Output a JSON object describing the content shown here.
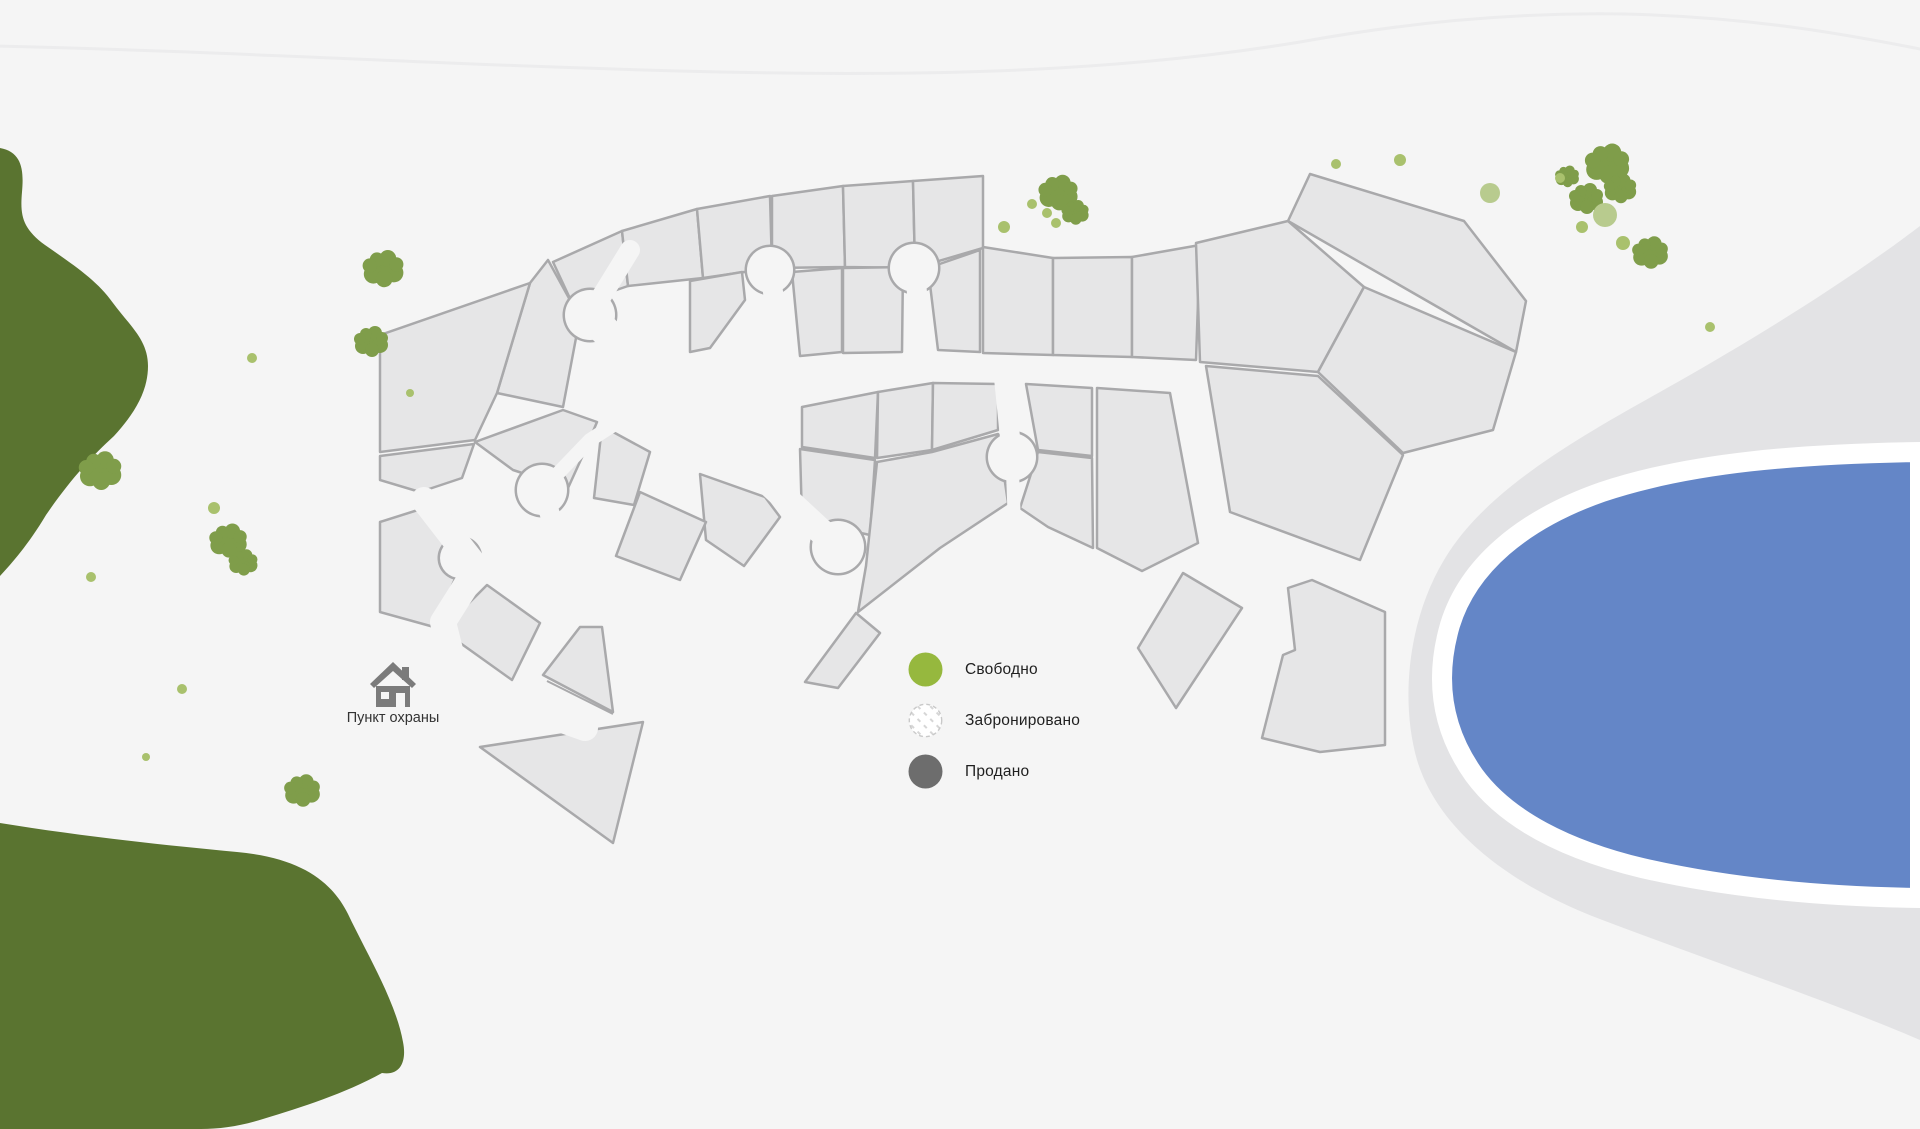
{
  "labels": {
    "security_point": "Пункт охраны"
  },
  "legend": {
    "items": [
      {
        "status": "free",
        "label": "Свободно",
        "color": "#96b83e"
      },
      {
        "status": "reserved",
        "label": "Забронировано",
        "color": "#ffffff",
        "border": "#c9c9c9",
        "pattern": "diagonal-dashes"
      },
      {
        "status": "sold",
        "label": "Продано",
        "color": "#6d6d6d"
      }
    ]
  },
  "palette": {
    "bg": "#f5f5f5",
    "plot": "#e6e6e7",
    "plot_border": "#a9a9ab",
    "forest": "#5a7430",
    "tree": "#7f9d4a",
    "tree_dot": "#a9c16d",
    "tree_dot_light": "#b8cb8e",
    "shore": "#e3e3e5",
    "water": "#6486c7",
    "water_rim": "#ffffff",
    "contour": "#ececed",
    "house_icon": "#7b7b7b"
  },
  "map": {
    "contour_line": "M-5,46 C250,52 460,66 720,72 C950,77 1130,70 1300,42 C1400,24 1505,12 1625,14 C1755,17 1855,36 1925,50",
    "forest": [
      "M0,148 C22,152 24,170 22,192 C20,215 22,228 45,245 C72,264 97,280 113,303 C130,326 148,340 148,366 C148,390 136,412 114,436 C92,456 70,480 46,515 C28,545 12,563 0,576 Z",
      "M0,823 C80,836 162,845 237,852 C302,858 332,882 348,914 C366,952 396,1002 403,1042 C407,1062 400,1076 382,1073 C344,1094 302,1107 263,1119 C241,1126 221,1129 201,1129 L0,1129 Z"
    ],
    "shore": "M1920,226 C1838,288 1742,346 1660,392 C1572,441 1484,492 1444,560 C1408,620 1400,700 1417,760 C1437,826 1502,880 1592,916 C1702,958 1832,1002 1920,1040 Z",
    "water": "M1920,452 C1800,454 1692,462 1602,492 C1522,520 1468,566 1450,625 C1434,680 1442,730 1474,775 C1507,820 1567,850 1642,868 C1742,891 1842,897 1920,898 Z",
    "plots": [
      "553,262 622,231 628,286 573,305",
      "622,231 697,209 703,278 628,286",
      "697,209 770,196 772,268 703,278",
      "772,196 843,186 845,267 772,268",
      "843,186 913,181 915,268 845,267",
      "913,181 983,176 983,248 915,268",
      "690,281 742,272 745,300 710,348 690,352",
      "792,272 842,268 842,352 800,356",
      "843,268 903,267 902,352 843,353",
      "928,268 980,250 980,352 938,350",
      "983,247 1053,258 1053,355 983,353",
      "1053,258 1132,257 1132,357 1053,355",
      "1132,257 1200,245 1196,360 1132,357",
      "1196,243 1288,221 1364,287 1318,372 1200,362",
      "1288,221 1310,174 1464,221 1526,301 1516,352",
      "1364,287 1516,352 1493,430 1403,453 1318,372",
      "1206,366 1318,376 1403,455 1360,560 1230,512",
      "802,407 878,392 875,458 802,447",
      "878,392 933,383 932,450 877,458",
      "933,383 998,384 998,430 932,450",
      "1026,384 1092,388 1092,456 1038,450",
      "1097,388 1170,393 1198,543 1142,571 1097,548",
      "800,449 875,460 870,535 802,520",
      "877,462 932,452 998,434 1008,503 940,548 858,612 866,566",
      "805,682 856,613 880,633 838,688",
      "1020,508 1038,452 1092,458 1093,548 1048,527",
      "700,474 765,497 780,517 744,566 706,540",
      "530,283 548,260 570,300 576,338 563,407 497,393",
      "380,335 530,283 497,393 475,440 380,452",
      "380,456 474,444 462,478 420,492 380,480",
      "475,442 563,410 597,422 583,455 568,488 513,470",
      "602,426 650,452 634,505 594,498",
      "640,492 706,522 680,580 616,556",
      "380,522 421,509 467,551 434,627 380,612",
      "442,630 487,585 540,623 512,680",
      "543,675 580,627 602,627 613,712",
      "480,747 643,722 613,843",
      "1183,573 1242,608 1176,708 1138,648",
      "1312,580 1385,612 1385,745 1320,752 1262,738 1283,655 1295,650 1288,588"
    ],
    "boundary_lines": [
      [
        547,
        681,
        613,
        714
      ]
    ],
    "culdesacs": [
      [
        770,
        270,
        23
      ],
      [
        914,
        268,
        24
      ],
      [
        1012,
        457,
        24
      ],
      [
        838,
        547,
        26
      ],
      [
        590,
        315,
        25
      ],
      [
        542,
        490,
        25
      ],
      [
        460,
        558,
        20
      ]
    ],
    "roads": [
      {
        "pts": [
          [
            770,
            270
          ],
          [
            782,
            358
          ]
        ],
        "w": 20
      },
      {
        "pts": [
          [
            914,
            268
          ],
          [
            925,
            358
          ]
        ],
        "w": 20
      },
      {
        "pts": [
          [
            1012,
            457
          ],
          [
            1004,
            378
          ]
        ],
        "w": 20
      },
      {
        "pts": [
          [
            1012,
            457
          ],
          [
            1014,
            512
          ]
        ],
        "w": 13
      },
      {
        "pts": [
          [
            838,
            547
          ],
          [
            757,
            472
          ],
          [
            700,
            437
          ]
        ],
        "w": 26
      },
      {
        "pts": [
          [
            590,
            315
          ],
          [
            630,
            250
          ]
        ],
        "w": 20
      },
      {
        "pts": [
          [
            590,
            315
          ],
          [
            650,
            378
          ],
          [
            690,
            420
          ]
        ],
        "w": 30
      },
      {
        "pts": [
          [
            542,
            490
          ],
          [
            578,
            600
          ]
        ],
        "w": 20
      },
      {
        "pts": [
          [
            542,
            490
          ],
          [
            590,
            440
          ],
          [
            618,
            422
          ]
        ],
        "w": 14
      },
      {
        "pts": [
          [
            424,
            500
          ],
          [
            455,
            540
          ],
          [
            477,
            568
          ],
          [
            443,
            622
          ],
          [
            452,
            658
          ],
          [
            490,
            690
          ],
          [
            540,
            712
          ],
          [
            585,
            728
          ]
        ],
        "w": 26
      }
    ],
    "trees": [
      [
        383,
        268,
        1.2
      ],
      [
        371,
        341,
        1.0
      ],
      [
        100,
        470,
        1.25
      ],
      [
        228,
        540,
        1.1
      ],
      [
        243,
        562,
        0.85
      ],
      [
        302,
        790,
        1.05
      ],
      [
        1058,
        192,
        1.15
      ],
      [
        1075,
        212,
        0.8
      ],
      [
        1607,
        163,
        1.3
      ],
      [
        1620,
        188,
        0.95
      ],
      [
        1586,
        198,
        1.0
      ],
      [
        1650,
        252,
        1.05
      ],
      [
        1567,
        176,
        0.7
      ]
    ],
    "dots": [
      [
        252,
        358,
        5,
        0
      ],
      [
        410,
        393,
        4,
        0
      ],
      [
        214,
        508,
        6,
        0
      ],
      [
        91,
        577,
        5,
        0
      ],
      [
        146,
        757,
        4,
        0
      ],
      [
        182,
        689,
        5,
        0
      ],
      [
        1004,
        227,
        6,
        0
      ],
      [
        1047,
        213,
        5,
        0
      ],
      [
        1032,
        204,
        5,
        0
      ],
      [
        1056,
        223,
        5,
        0
      ],
      [
        1336,
        164,
        5,
        0
      ],
      [
        1400,
        160,
        6,
        0
      ],
      [
        1490,
        193,
        10,
        1
      ],
      [
        1560,
        178,
        5,
        0
      ],
      [
        1605,
        215,
        12,
        1
      ],
      [
        1582,
        227,
        6,
        0
      ],
      [
        1623,
        243,
        7,
        0
      ],
      [
        1710,
        327,
        5,
        0
      ]
    ]
  }
}
